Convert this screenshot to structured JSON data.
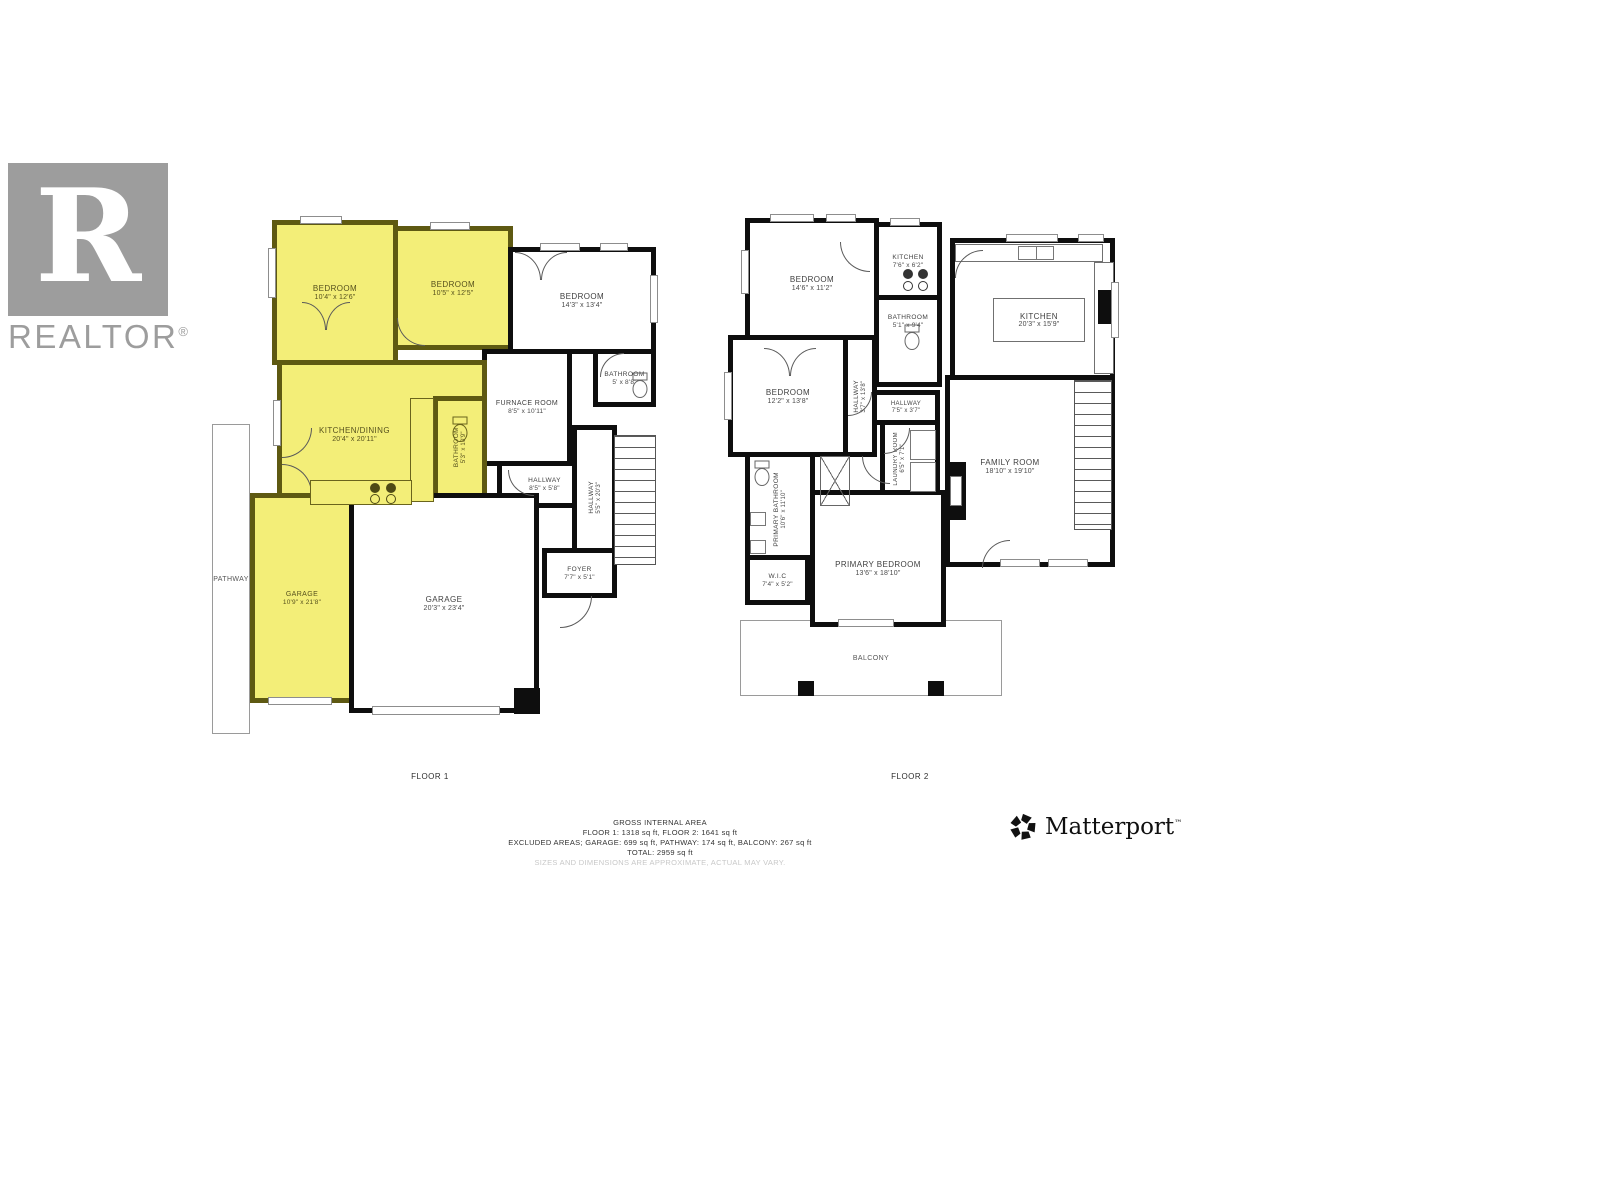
{
  "branding": {
    "realtor": {
      "letter": "R",
      "wordmark": "REALTOR",
      "registered": "®",
      "color": "#9d9d9d"
    },
    "matterport": {
      "wordmark": "Matterport",
      "mark": "™",
      "color": "#0f0f0f"
    }
  },
  "colors": {
    "highlight": "#f3ee78",
    "wall": "#0e0e0e",
    "highlight_wall": "#5e5912"
  },
  "floor1": {
    "label": "FLOOR 1",
    "rooms": [
      {
        "name": "BEDROOM",
        "dims": "10'4\" x 12'6\""
      },
      {
        "name": "BEDROOM",
        "dims": "10'5\" x 12'5\""
      },
      {
        "name": "BEDROOM",
        "dims": "14'3\" x 13'4\""
      },
      {
        "name": "BATHROOM",
        "dims": "5' x 8'8\""
      },
      {
        "name": "FURNACE ROOM",
        "dims": "8'5\" x 10'11\""
      },
      {
        "name": "KITCHEN/DINING",
        "dims": "20'4\" x 20'11\""
      },
      {
        "name": "BATHROOM",
        "dims": "5'3\" x 10'9\""
      },
      {
        "name": "HALLWAY",
        "dims": "8'5\" x 5'8\""
      },
      {
        "name": "HALLWAY",
        "dims": "5'5\" x 20'3\""
      },
      {
        "name": "FOYER",
        "dims": "7'7\" x 5'1\""
      },
      {
        "name": "GARAGE",
        "dims": "10'9\" x 21'8\""
      },
      {
        "name": "GARAGE",
        "dims": "20'3\" x 23'4\""
      },
      {
        "name": "PATHWAY",
        "dims": ""
      }
    ]
  },
  "floor2": {
    "label": "FLOOR 2",
    "rooms": [
      {
        "name": "BEDROOM",
        "dims": "14'6\" x 11'2\""
      },
      {
        "name": "KITCHEN",
        "dims": "7'6\" x 6'2\""
      },
      {
        "name": "BATHROOM",
        "dims": "5'1\" x 9'4\""
      },
      {
        "name": "KITCHEN",
        "dims": "20'3\" x 15'9\""
      },
      {
        "name": "BEDROOM",
        "dims": "12'2\" x 13'8\""
      },
      {
        "name": "HALLWAY",
        "dims": "3'7\" x 13'8\""
      },
      {
        "name": "HALLWAY",
        "dims": "7'5\" x 3'7\""
      },
      {
        "name": "LAUNDRY ROOM",
        "dims": "6'5\" x 7'1\""
      },
      {
        "name": "FAMILY ROOM",
        "dims": "18'10\" x 19'10\""
      },
      {
        "name": "PRIMARY BATHROOM",
        "dims": "10'6\" x 11'10\""
      },
      {
        "name": "PRIMARY BEDROOM",
        "dims": "13'6\" x 18'10\""
      },
      {
        "name": "W.I.C",
        "dims": "7'4\" x 5'2\""
      },
      {
        "name": "BALCONY",
        "dims": ""
      }
    ]
  },
  "footer": {
    "title": "GROSS INTERNAL AREA",
    "floors": "FLOOR 1: 1318 sq ft, FLOOR 2: 1641 sq ft",
    "excluded": "EXCLUDED AREAS; GARAGE: 699 sq ft, PATHWAY: 174 sq ft, BALCONY: 267 sq ft",
    "total": "TOTAL: 2959 sq ft",
    "disclaimer": "SIZES AND DIMENSIONS ARE APPROXIMATE, ACTUAL MAY VARY."
  }
}
